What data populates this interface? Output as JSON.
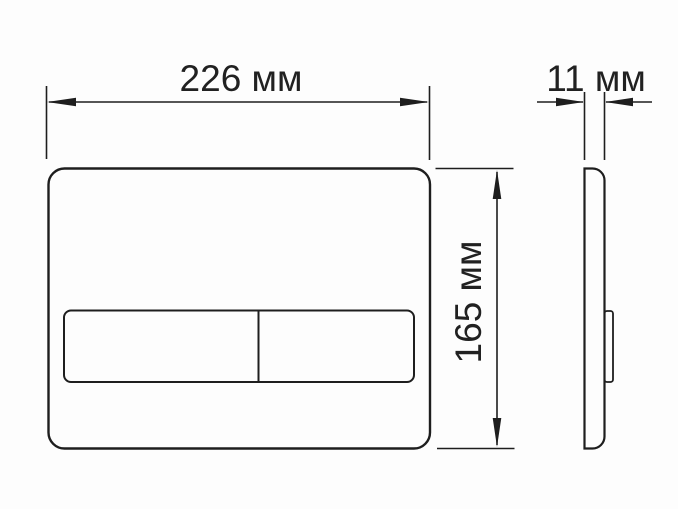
{
  "diagram": {
    "type": "technical-drawing",
    "subject": "flush-plate-with-two-buttons-front-and-side-views",
    "unit": "мм",
    "dimensions": {
      "width": {
        "value": 226,
        "label": "226 мм"
      },
      "height": {
        "value": 165,
        "label": "165 мм"
      },
      "depth": {
        "value": 11,
        "label": "11 мм"
      }
    },
    "views": {
      "front": "plate with horizontal two-section button bar",
      "side": "thin profile with button protrusion on right edge"
    },
    "colors": {
      "line": "#1e1e1e",
      "background": "#fdfdfd",
      "text": "#212121"
    }
  }
}
